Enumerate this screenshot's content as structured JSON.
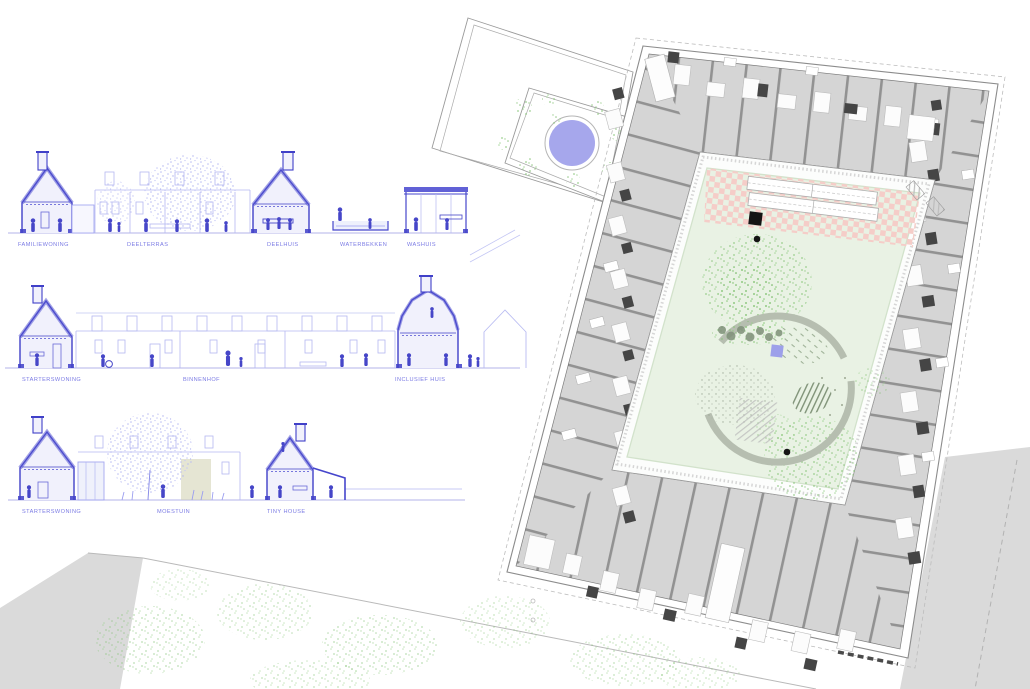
{
  "drawing": {
    "type": "architectural-presentation",
    "left_panel": "building-sections",
    "right_panel": "courtyard-floor-plan"
  },
  "sections": {
    "rows": [
      {
        "name": "row-1",
        "labels": [
          {
            "text": "FAMILIEWONING"
          },
          {
            "text": "DEELTERRAS"
          },
          {
            "text": "DEELHUIS"
          },
          {
            "text": "WATERBEKKEN"
          },
          {
            "text": "WASHUIS"
          }
        ]
      },
      {
        "name": "row-2",
        "labels": [
          {
            "text": "STARTERSWONING"
          },
          {
            "text": "BINNENHOF"
          },
          {
            "text": "INCLUSIEF HUIS"
          }
        ]
      },
      {
        "name": "row-3",
        "labels": [
          {
            "text": "STARTERSWONING"
          },
          {
            "text": "MOESTUIN"
          },
          {
            "text": "TINY HOUSE"
          }
        ]
      }
    ]
  },
  "colors": {
    "section_line_blue": "#4444cc",
    "section_faint_blue": "#b7baf2",
    "label_blue": "#7b7be4",
    "pond_blue": "#a6a7ec",
    "courtyard_lawn_green": "#e9f2e4",
    "terrace_pink": "#f5cdc8",
    "room_floor_gray": "#d5d5d5",
    "wall_dark_gray": "#4a4a4a",
    "path_arc_gray_green": "#b6beb0",
    "context_gray": "#dadada",
    "vegetation_green": "#86c476"
  }
}
